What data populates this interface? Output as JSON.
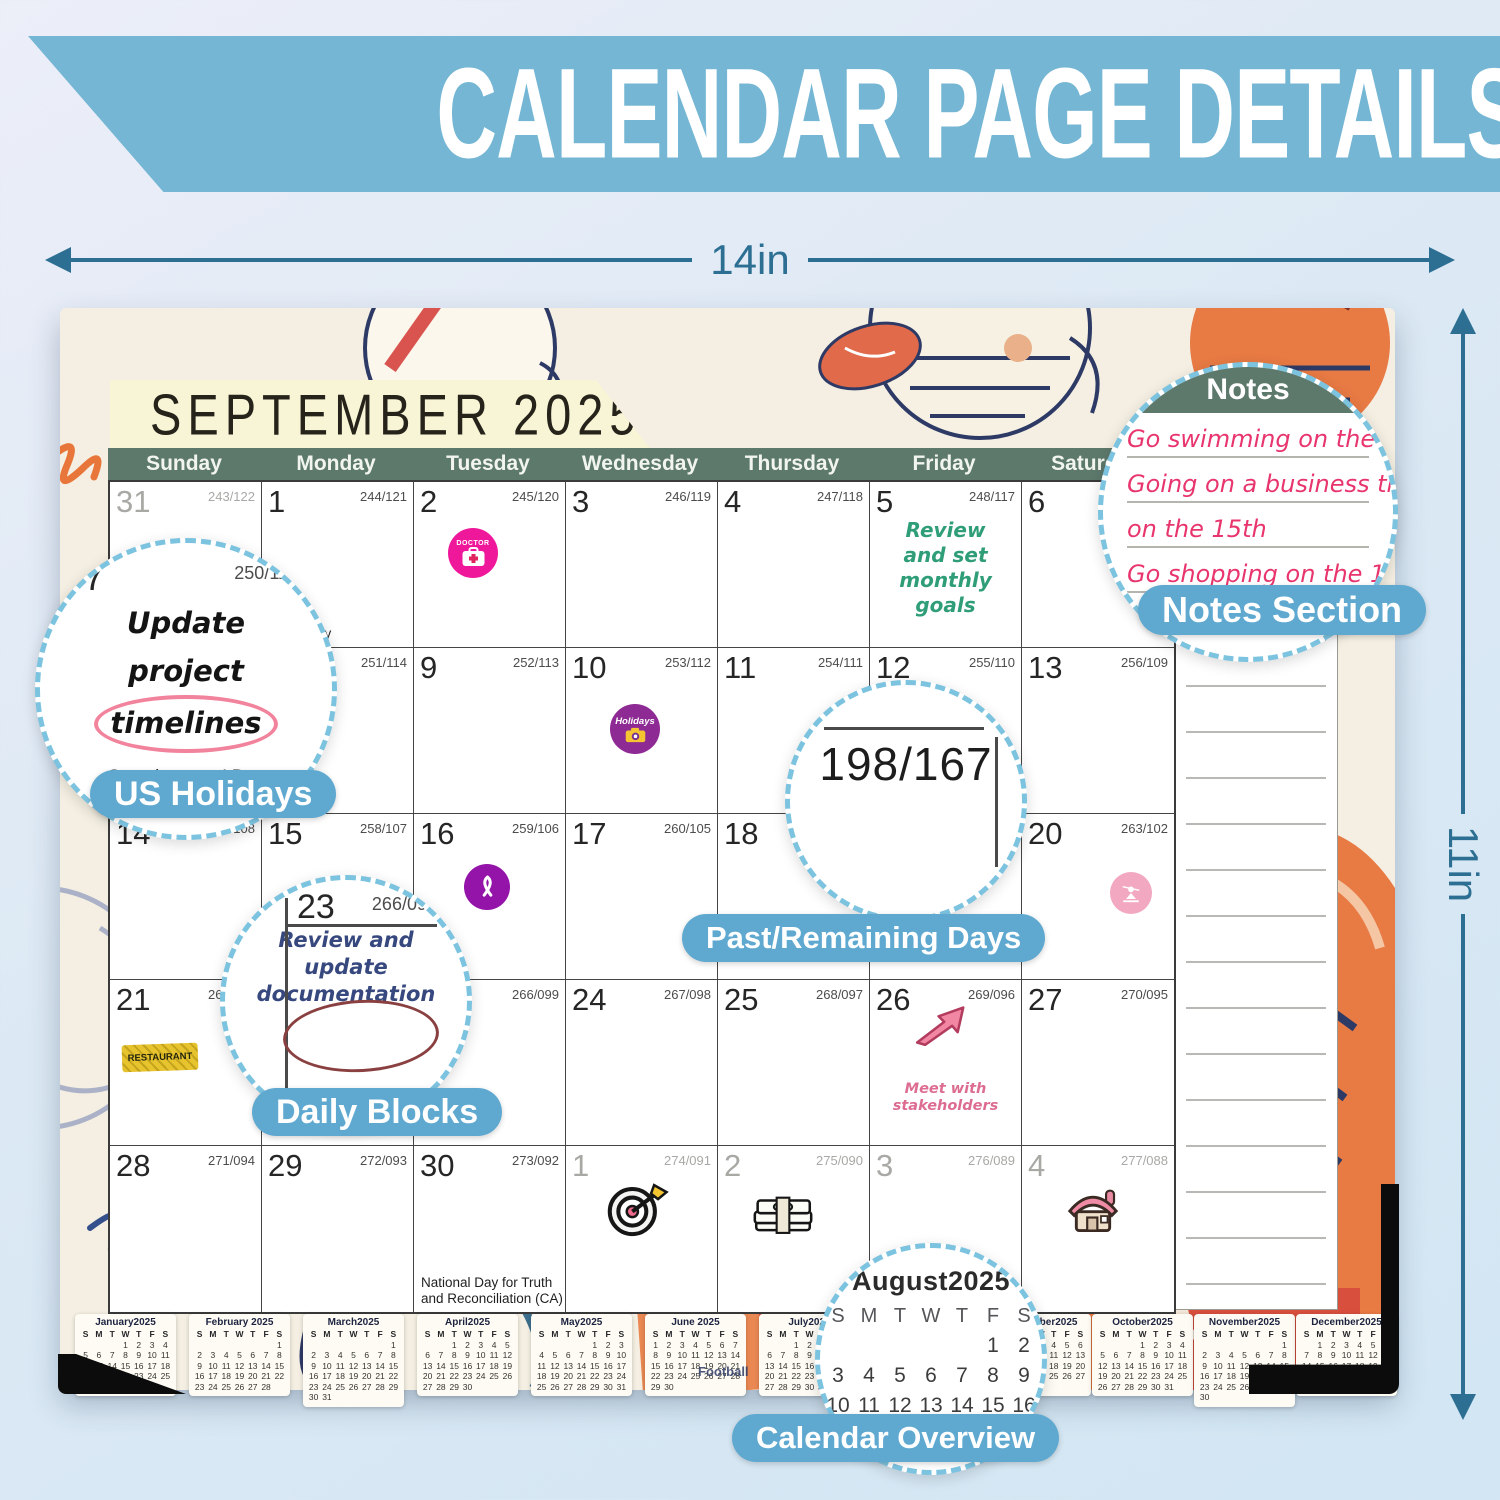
{
  "banner": {
    "title": "CALENDAR PAGE DETAILS"
  },
  "dimensions": {
    "width_label": "14in",
    "height_label": "11in"
  },
  "art_text": "Football",
  "colors": {
    "banner_blue": "#74b6d4",
    "arrow_teal": "#2c6f92",
    "pill_blue": "#5fa9d1",
    "header_green": "#5d796c",
    "month_banner": "#f8f4d6",
    "page_cream": "#f4efe2",
    "notes_pink": "#e8356d",
    "goal_green": "#2f9e77"
  },
  "calendar": {
    "month_title": "SEPTEMBER 2025",
    "weekdays": [
      "Sunday",
      "Monday",
      "Tuesday",
      "Wednesday",
      "Thursday",
      "Friday",
      "Saturday"
    ],
    "notes_header": "Notes",
    "mini_weekdays": [
      "S",
      "M",
      "T",
      "W",
      "T",
      "F",
      "S"
    ],
    "cells": [
      {
        "day": "31",
        "count": "243/122",
        "dim": true
      },
      {
        "day": "1",
        "count": "244/121",
        "holiday": "Labor Day"
      },
      {
        "day": "2",
        "count": "245/120",
        "sticker": "doctor",
        "sticker_label": "DOCTOR"
      },
      {
        "day": "3",
        "count": "246/119"
      },
      {
        "day": "4",
        "count": "247/118"
      },
      {
        "day": "5",
        "count": "248/117",
        "note": [
          "Review",
          "and set",
          "monthly",
          "goals"
        ],
        "note_color": "green"
      },
      {
        "day": "6",
        "count": "249/116"
      },
      {
        "day": "7",
        "count": "250/115"
      },
      {
        "day": "8",
        "count": "251/114"
      },
      {
        "day": "9",
        "count": "252/113"
      },
      {
        "day": "10",
        "count": "253/112",
        "sticker": "holidays",
        "sticker_label": "Holidays"
      },
      {
        "day": "11",
        "count": "254/111"
      },
      {
        "day": "12",
        "count": "255/110"
      },
      {
        "day": "13",
        "count": "256/109"
      },
      {
        "day": "14",
        "count": "257/108"
      },
      {
        "day": "15",
        "count": "258/107"
      },
      {
        "day": "16",
        "count": "259/106",
        "sticker": "ribbon"
      },
      {
        "day": "17",
        "count": "260/105"
      },
      {
        "day": "18",
        "count": "261/104"
      },
      {
        "day": "19",
        "count": "262/103"
      },
      {
        "day": "20",
        "count": "263/102",
        "sticker": "yoga"
      },
      {
        "day": "21",
        "count": "264/101",
        "sticker": "restaurant",
        "sticker_label": "RESTAURANT"
      },
      {
        "day": "22",
        "count": "265/100"
      },
      {
        "day": "23",
        "count": "266/099"
      },
      {
        "day": "24",
        "count": "267/098"
      },
      {
        "day": "25",
        "count": "268/097"
      },
      {
        "day": "26",
        "count": "269/096",
        "sticker": "arrow",
        "note": [
          "Meet with",
          "stakeholders"
        ],
        "note_color": "pink"
      },
      {
        "day": "27",
        "count": "270/095"
      },
      {
        "day": "28",
        "count": "271/094"
      },
      {
        "day": "29",
        "count": "272/093"
      },
      {
        "day": "30",
        "count": "273/092",
        "holiday": "National Day for Truth and Reconciliation (CA)"
      },
      {
        "day": "1",
        "count": "274/091",
        "dim": true,
        "sticker": "dart"
      },
      {
        "day": "2",
        "count": "275/090",
        "dim": true,
        "sticker": "money"
      },
      {
        "day": "3",
        "count": "276/089",
        "dim": true
      },
      {
        "day": "4",
        "count": "277/088",
        "dim": true,
        "sticker": "house"
      }
    ]
  },
  "magnifiers": {
    "notes": {
      "header": "Notes",
      "lines": [
        "Go swimming on the 3rd",
        "Going on a business trip",
        "on the 15th",
        "Go shopping on the 18th"
      ],
      "label": "Notes Section"
    },
    "us_holidays": {
      "day": "7",
      "count": "250/11",
      "lines": [
        "Update",
        "project",
        "timelines"
      ],
      "holiday": "Grandparents' Day",
      "label": "US Holidays"
    },
    "past_remaining": {
      "value": "198/167",
      "label": "Past/Remaining Days"
    },
    "daily_blocks": {
      "day": "23",
      "count": "266/095",
      "lines": [
        "Review and",
        "update",
        "documentation"
      ],
      "label": "Daily Blocks"
    },
    "overview": {
      "title": "August2025",
      "weeks": [
        [
          "",
          "",
          "",
          "",
          "",
          "1",
          "2"
        ],
        [
          "3",
          "4",
          "5",
          "6",
          "7",
          "8",
          "9"
        ],
        [
          "10",
          "11",
          "12",
          "13",
          "14",
          "15",
          "16"
        ],
        [
          "17",
          "18",
          "19",
          "20",
          "21",
          "22",
          "23"
        ]
      ],
      "label": "Calendar Overview"
    }
  },
  "mini_calendars": [
    {
      "title": "January2025",
      "weeks": [
        [
          "",
          "",
          "",
          "1",
          "2",
          "3",
          "4"
        ],
        [
          "5",
          "6",
          "7",
          "8",
          "9",
          "10",
          "11"
        ],
        [
          "12",
          "13",
          "14",
          "15",
          "16",
          "17",
          "18"
        ],
        [
          "19",
          "20",
          "21",
          "22",
          "23",
          "24",
          "25"
        ],
        [
          "26",
          "27",
          "28",
          "29",
          "30",
          "31",
          ""
        ]
      ]
    },
    {
      "title": "February 2025",
      "weeks": [
        [
          "",
          "",
          "",
          "",
          "",
          "",
          "1"
        ],
        [
          "2",
          "3",
          "4",
          "5",
          "6",
          "7",
          "8"
        ],
        [
          "9",
          "10",
          "11",
          "12",
          "13",
          "14",
          "15"
        ],
        [
          "16",
          "17",
          "18",
          "19",
          "20",
          "21",
          "22"
        ],
        [
          "23",
          "24",
          "25",
          "26",
          "27",
          "28",
          ""
        ]
      ]
    },
    {
      "title": "March2025",
      "weeks": [
        [
          "",
          "",
          "",
          "",
          "",
          "",
          "1"
        ],
        [
          "2",
          "3",
          "4",
          "5",
          "6",
          "7",
          "8"
        ],
        [
          "9",
          "10",
          "11",
          "12",
          "13",
          "14",
          "15"
        ],
        [
          "16",
          "17",
          "18",
          "19",
          "20",
          "21",
          "22"
        ],
        [
          "23",
          "24",
          "25",
          "26",
          "27",
          "28",
          "29"
        ],
        [
          "30",
          "31",
          "",
          "",
          "",
          "",
          ""
        ]
      ]
    },
    {
      "title": "April2025",
      "weeks": [
        [
          "",
          "",
          "1",
          "2",
          "3",
          "4",
          "5"
        ],
        [
          "6",
          "7",
          "8",
          "9",
          "10",
          "11",
          "12"
        ],
        [
          "13",
          "14",
          "15",
          "16",
          "17",
          "18",
          "19"
        ],
        [
          "20",
          "21",
          "22",
          "23",
          "24",
          "25",
          "26"
        ],
        [
          "27",
          "28",
          "29",
          "30",
          "",
          "",
          ""
        ]
      ]
    },
    {
      "title": "May2025",
      "weeks": [
        [
          "",
          "",
          "",
          "",
          "1",
          "2",
          "3"
        ],
        [
          "4",
          "5",
          "6",
          "7",
          "8",
          "9",
          "10"
        ],
        [
          "11",
          "12",
          "13",
          "14",
          "15",
          "16",
          "17"
        ],
        [
          "18",
          "19",
          "20",
          "21",
          "22",
          "23",
          "24"
        ],
        [
          "25",
          "26",
          "27",
          "28",
          "29",
          "30",
          "31"
        ]
      ]
    },
    {
      "title": "June 2025",
      "weeks": [
        [
          "1",
          "2",
          "3",
          "4",
          "5",
          "6",
          "7"
        ],
        [
          "8",
          "9",
          "10",
          "11",
          "12",
          "13",
          "14"
        ],
        [
          "15",
          "16",
          "17",
          "18",
          "19",
          "20",
          "21"
        ],
        [
          "22",
          "23",
          "24",
          "25",
          "26",
          "27",
          "28"
        ],
        [
          "29",
          "30",
          "",
          "",
          "",
          "",
          ""
        ]
      ]
    },
    {
      "title": "July2025",
      "weeks": [
        [
          "",
          "",
          "1",
          "2",
          "3",
          "4",
          "5"
        ],
        [
          "6",
          "7",
          "8",
          "9",
          "10",
          "11",
          "12"
        ],
        [
          "13",
          "14",
          "15",
          "16",
          "17",
          "18",
          "19"
        ],
        [
          "20",
          "21",
          "22",
          "23",
          "24",
          "25",
          "26"
        ],
        [
          "27",
          "28",
          "29",
          "30",
          "31",
          "",
          ""
        ]
      ]
    },
    {
      "title": "September2025",
      "weeks": [
        [
          "",
          "1",
          "2",
          "3",
          "4",
          "5",
          "6"
        ],
        [
          "7",
          "8",
          "9",
          "10",
          "11",
          "12",
          "13"
        ],
        [
          "14",
          "15",
          "16",
          "17",
          "18",
          "19",
          "20"
        ],
        [
          "21",
          "22",
          "23",
          "24",
          "25",
          "26",
          "27"
        ],
        [
          "28",
          "29",
          "30",
          "",
          "",
          "",
          ""
        ]
      ]
    },
    {
      "title": "October2025",
      "weeks": [
        [
          "",
          "",
          "",
          "1",
          "2",
          "3",
          "4"
        ],
        [
          "5",
          "6",
          "7",
          "8",
          "9",
          "10",
          "11"
        ],
        [
          "12",
          "13",
          "14",
          "15",
          "16",
          "17",
          "18"
        ],
        [
          "19",
          "20",
          "21",
          "22",
          "23",
          "24",
          "25"
        ],
        [
          "26",
          "27",
          "28",
          "29",
          "30",
          "31",
          ""
        ]
      ]
    },
    {
      "title": "November2025",
      "weeks": [
        [
          "",
          "",
          "",
          "",
          "",
          "",
          "1"
        ],
        [
          "2",
          "3",
          "4",
          "5",
          "6",
          "7",
          "8"
        ],
        [
          "9",
          "10",
          "11",
          "12",
          "13",
          "14",
          "15"
        ],
        [
          "16",
          "17",
          "18",
          "19",
          "20",
          "21",
          "22"
        ],
        [
          "23",
          "24",
          "25",
          "26",
          "27",
          "28",
          "29"
        ],
        [
          "30",
          "",
          "",
          "",
          "",
          "",
          ""
        ]
      ]
    },
    {
      "title": "December2025",
      "weeks": [
        [
          "",
          "1",
          "2",
          "3",
          "4",
          "5",
          "6"
        ],
        [
          "7",
          "8",
          "9",
          "10",
          "11",
          "12",
          "13"
        ],
        [
          "14",
          "15",
          "16",
          "17",
          "18",
          "19",
          "20"
        ],
        [
          "21",
          "22",
          "23",
          "24",
          "25",
          "26",
          "27"
        ],
        [
          "28",
          "29",
          "30",
          "31",
          "",
          "",
          ""
        ]
      ]
    }
  ]
}
